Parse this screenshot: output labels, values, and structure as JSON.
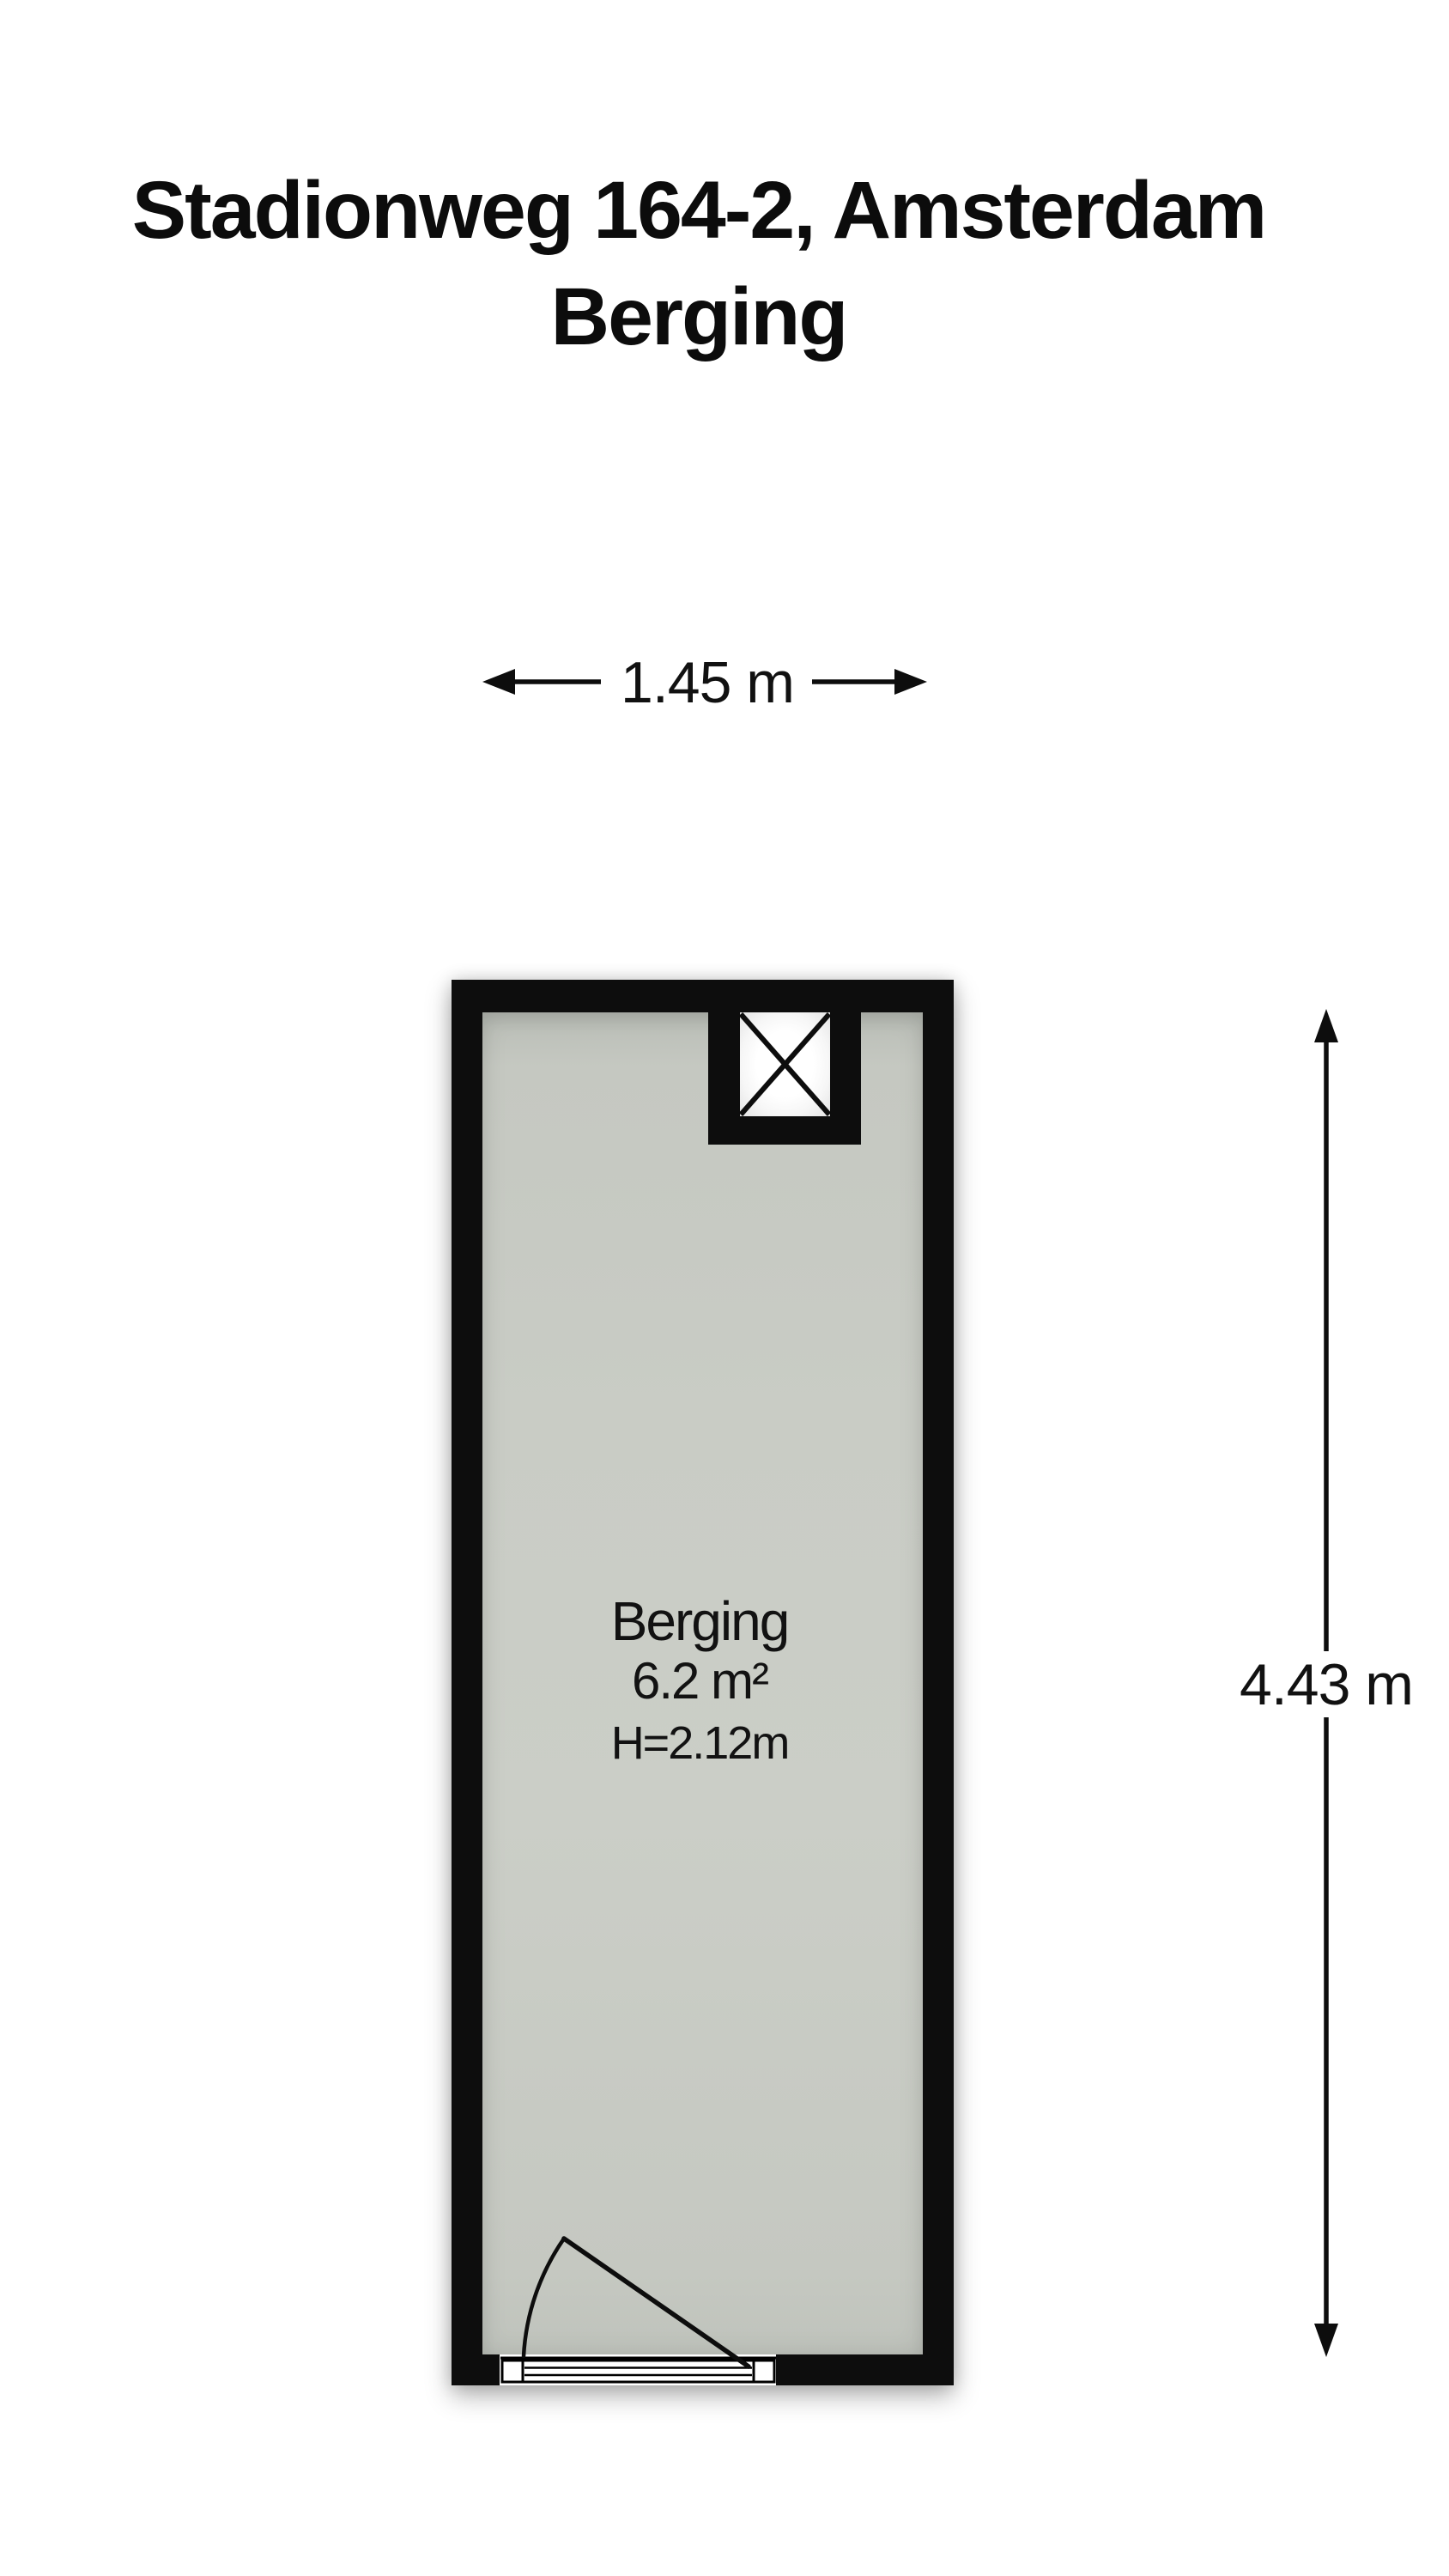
{
  "title": {
    "line1": "Stadionweg 164-2, Amsterdam",
    "line2": "Berging"
  },
  "plan": {
    "room": {
      "name": "Berging",
      "area": "6.2 m²",
      "ceiling_height": "H=2.12m"
    },
    "dimensions": {
      "width": "1.45 m",
      "depth": "4.43 m"
    },
    "colors": {
      "wall": "#0d0d0d",
      "floor": "#c9ccc5",
      "background": "#ffffff",
      "text": "#111111"
    },
    "symbols": {
      "shaft": "crossed-box-shaft",
      "door": "single-swing-door-bottom-wall"
    }
  }
}
